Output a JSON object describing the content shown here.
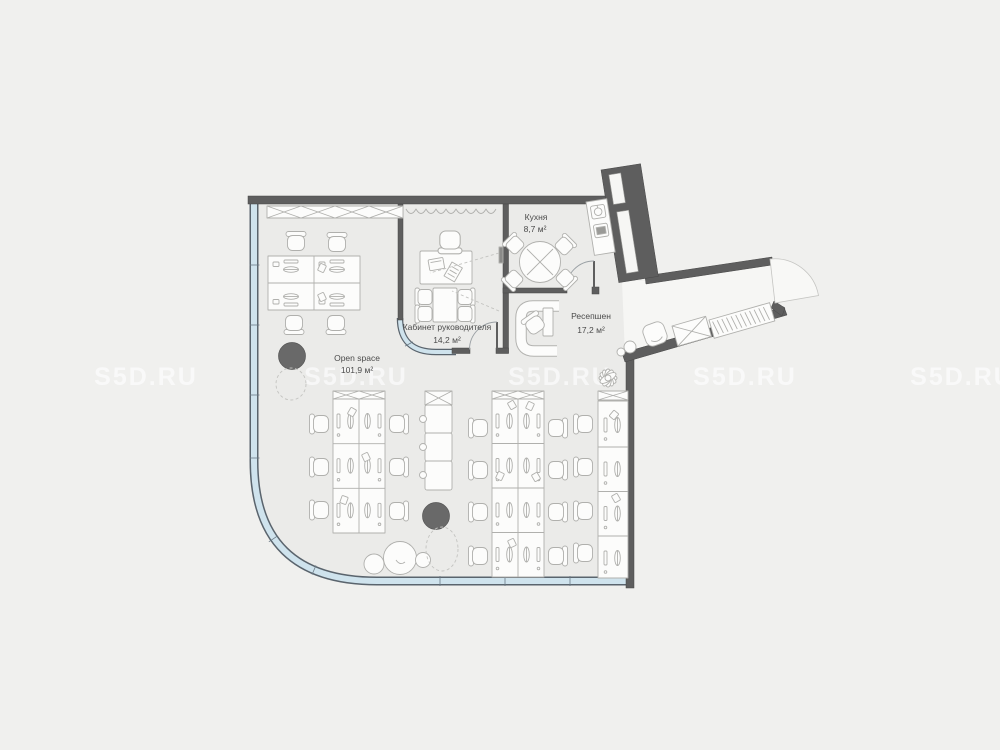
{
  "plan": {
    "watermark": {
      "text": "S5D.RU"
    },
    "rooms": [
      {
        "name": "Open space",
        "area": "101,9 м²"
      },
      {
        "name": "Кабинет руководителя",
        "area": "14,2 м²"
      },
      {
        "name": "Кухня",
        "area": "8,7 м²"
      },
      {
        "name": "Ресепшен",
        "area": "17,2 м²"
      }
    ],
    "colors": {
      "background": "#f0f0ee",
      "floor": "#ebebe9",
      "corridor_floor": "#f6f6f4",
      "wall": "#5e5e5e",
      "glazing": "#cfe3ed",
      "column": "#696969",
      "furniture_stroke": "#b0b0ad",
      "label_text": "#4b4b4b",
      "watermark": "rgba(255,255,255,0.62)"
    },
    "icons": {
      "column": "structural-column",
      "plant": "plant",
      "chair": "office-chair",
      "desk": "workstation-desk",
      "cabinet": "storage-cabinet-x",
      "wardrobe": "wardrobe-cabinet",
      "coat_rail": "coat-hanger-rail",
      "door": "door-swing",
      "window": "glazed-facade",
      "sink": "kitchen-sink",
      "stove": "kitchen-stove",
      "tv": "wall-tv"
    }
  }
}
